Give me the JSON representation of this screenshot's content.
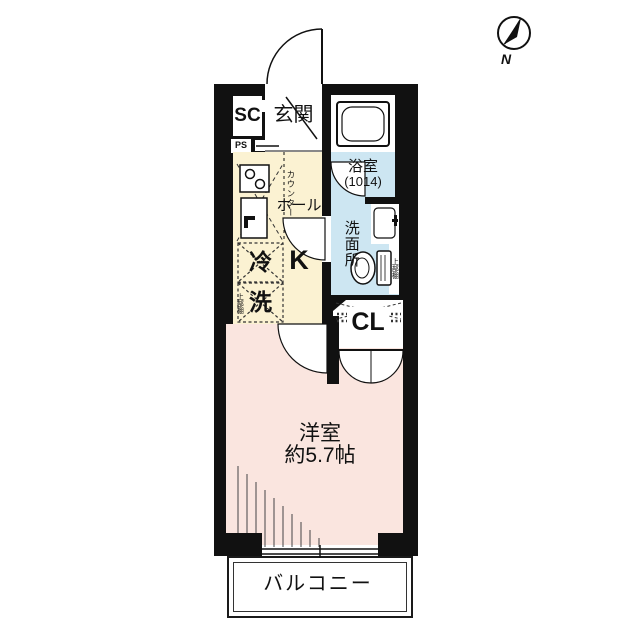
{
  "compass": {
    "label": "N"
  },
  "rooms": {
    "shoe_closet": "SC",
    "entrance": "玄関",
    "pipe_space": "PS",
    "counter": "カウンター",
    "bathroom": "浴室",
    "bathroom_size": "(1014)",
    "hall": "ホール",
    "kitchen": "K",
    "fridge": "冷",
    "washer": "洗",
    "upper_shelf_left": "上部棚",
    "washroom": "洗面所",
    "upper_shelf_right": "上部棚",
    "closet": "CL",
    "main_room": "洋室",
    "main_room_size": "約5.7帖",
    "balcony": "バルコニー"
  },
  "colors": {
    "wall": "#111111",
    "kitchen": "#FBF2D2",
    "wet": "#CDE6F2",
    "room": "#FAE5DF"
  }
}
